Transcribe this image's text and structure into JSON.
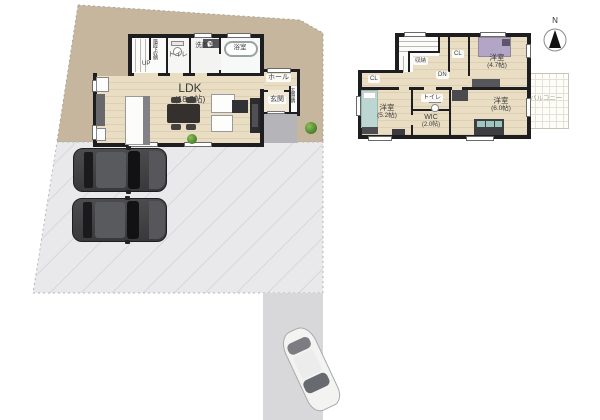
{
  "colors": {
    "lot": "#c6b69e",
    "parking": "#e9e9eb",
    "parkline": "#d2d2d6",
    "driveway": "#d8d8da",
    "wood": "#e9ddc4",
    "woodline": "#dccfb2",
    "wall": "#1e1e20",
    "porch": "#b4b4b9",
    "porchline": "#cfcfd3",
    "balline": "#e6e3d6",
    "plantlight": "#8fbf5a",
    "plantdark": "#467f2c",
    "labeldark": "#3b3b3d",
    "balconytext": "#a49e92"
  },
  "compass": {
    "north": "N"
  },
  "floor1": {
    "stair_storage": "階段下収納",
    "up": "UP",
    "toilet": "トイレ",
    "washroom": "洗面室",
    "bathroom": "浴室",
    "hall": "ホール",
    "entrance": "玄関",
    "entrance_storage": "玄関収納",
    "ldk": {
      "name": "LDK",
      "size": "(18.2帖)"
    }
  },
  "floor2": {
    "storage": "収納",
    "dn": "DN",
    "cl_top": "CL",
    "cl_left": "CL",
    "toilet": "トイレ",
    "wic": {
      "name": "WIC",
      "size": "(2.0帖)"
    },
    "bedroom_a": {
      "name": "洋室",
      "size": "(4.7帖)"
    },
    "bedroom_b": {
      "name": "洋室",
      "size": "(5.2帖)"
    },
    "bedroom_c": {
      "name": "洋室",
      "size": "(6.0帖)"
    },
    "balcony": "バルコニー"
  }
}
